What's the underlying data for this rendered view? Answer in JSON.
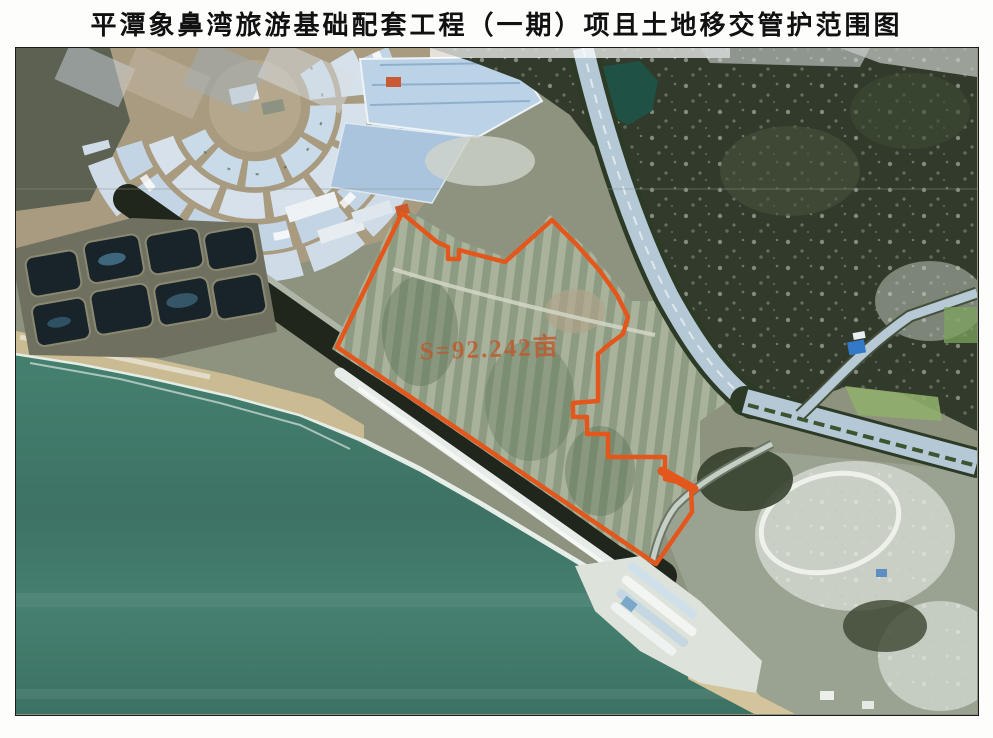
{
  "page": {
    "title": "平潭象鼻湾旅游基础配套工程（一期）项且土地移交管护范围图"
  },
  "map": {
    "type": "satellite-imagery-with-parcel-overlay",
    "parcel": {
      "area_label": "S=92.242亩",
      "boundary_style": "solid orange polygon"
    }
  },
  "colors": {
    "title": "#111111",
    "border": "#1b1b1b",
    "boundary": "#e4571c",
    "area_label": "#bf5a2e",
    "sea": "#45806f",
    "sea_deep": "#3d7264",
    "surf": "#edf3ee",
    "beach": "#cabb93",
    "fields": "#a3ad97",
    "field_rows": "#75886a",
    "hill": "#313a2b",
    "road": "#b4c8d6",
    "coastal_strip": "#20261c",
    "ponds": "#18232a",
    "greenhouses": "#c9dae8",
    "rocky": "#ccd2c8"
  }
}
